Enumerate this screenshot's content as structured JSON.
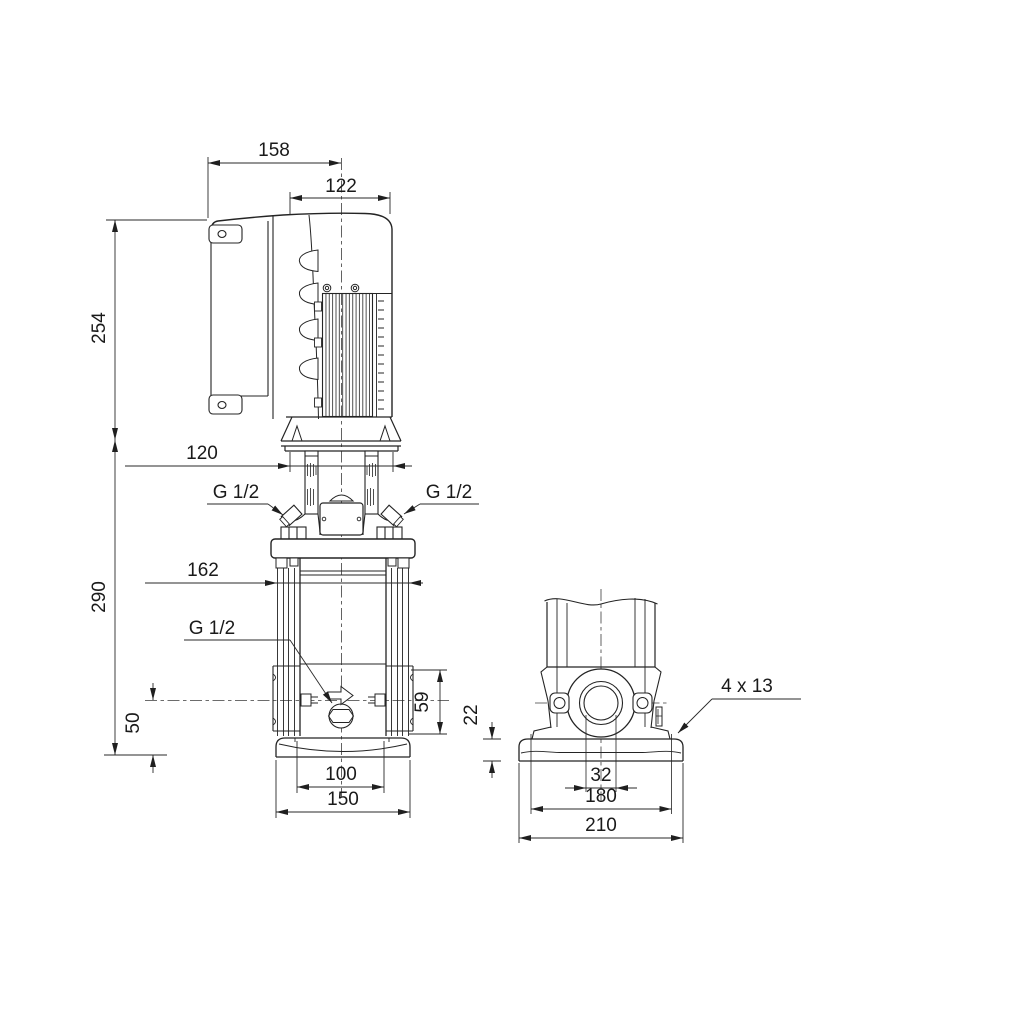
{
  "front_view": {
    "dim_158": "158",
    "dim_122": "122",
    "dim_254": "254",
    "dim_120": "120",
    "dim_290": "290",
    "dim_162": "162",
    "dim_50": "50",
    "dim_59": "59",
    "dim_100": "100",
    "dim_150": "150",
    "vent_plug_left": "G 1/2",
    "vent_plug_right": "G 1/2",
    "drain_plug": "G 1/2"
  },
  "side_view": {
    "dim_22": "22",
    "dim_32": "32",
    "dim_180": "180",
    "dim_210": "210",
    "base_holes": "4 x 13"
  }
}
